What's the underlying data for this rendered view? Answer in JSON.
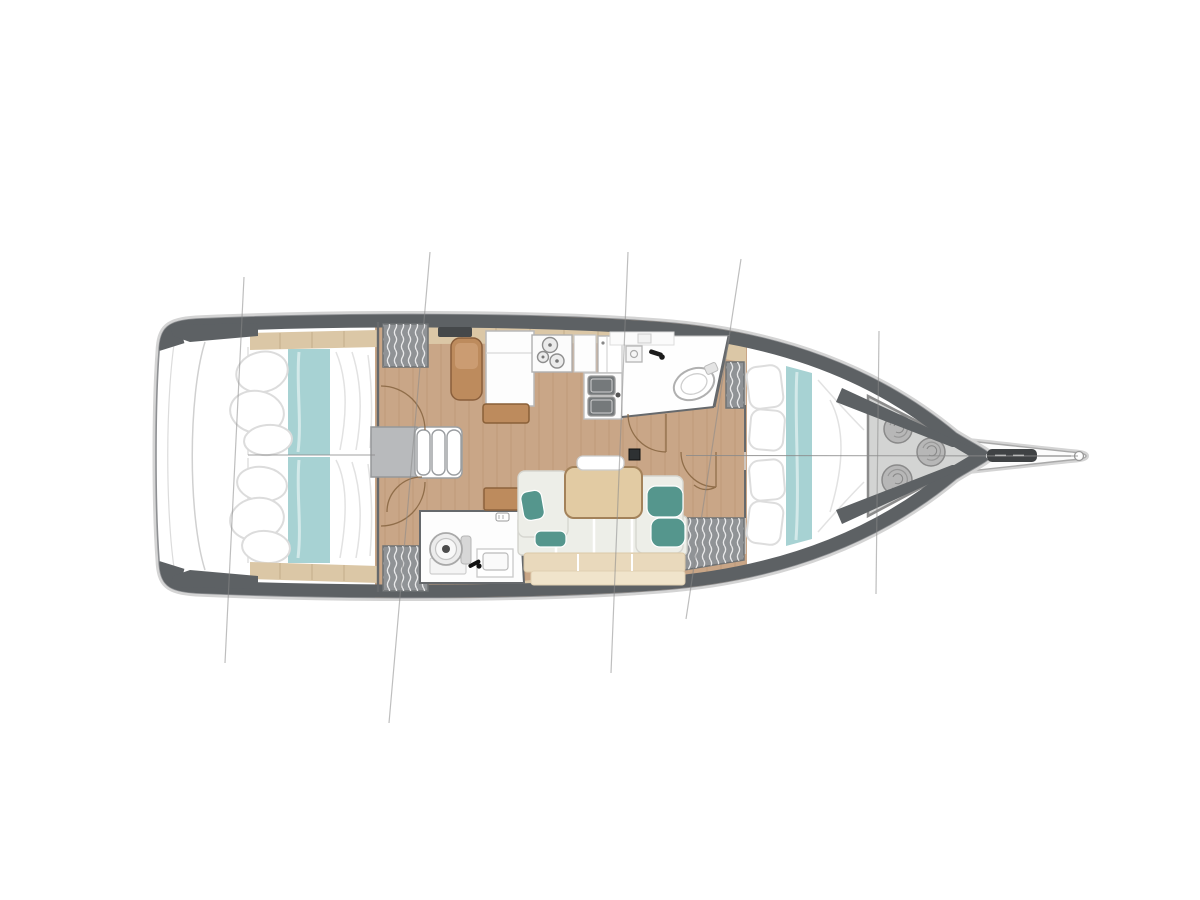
{
  "diagram": {
    "type": "sailboat-interior-deck-plan",
    "orientation": "bow-right",
    "rooms": [
      "port aft cabin",
      "starboard aft cabin",
      "companionway",
      "galley",
      "navigation station",
      "forward head",
      "aft head",
      "salon dinette",
      "forward cabin",
      "sail locker",
      "bowsprit"
    ],
    "counts": {
      "aft_cabins": 2,
      "heads": 2,
      "companionway_steps": 3,
      "stove_burners": 3,
      "galley_sink_basins": 2,
      "rope_coils": 3,
      "wardrobe_lockers": 4,
      "salon_throw_pillows": 4,
      "hull_section_lines": 5
    }
  },
  "colors": {
    "page_bg": "#ffffff",
    "hull_white": "#ffffff",
    "hull_outline": "#8e9093",
    "hull_halo": "#d4d4d4",
    "deck_gray": "#5d6164",
    "floor_wood": "#c9a687",
    "shelf_tan": "#dbc7a6",
    "aqua_bedding": "#a7d2d3",
    "sofa_cream": "#edeee8",
    "sofa_back_tan": "#e9d9bc",
    "sofa_back_light": "#f0e4cb",
    "pillow_teal": "#55968d",
    "table_wood": "#e2cba3",
    "cabinet_brown": "#bd8b5d",
    "stairs_gray": "#b8babc",
    "locker_gray": "#909396",
    "sail_locker_gray": "#d3d4d3",
    "wall_dark": "#66696c",
    "door_arc_brown": "#8a6844",
    "rope_gray": "#b7b7b7",
    "section_line": "#8a8a8a",
    "basin_dark": "#75797b",
    "roller_dark": "#3f4244"
  }
}
